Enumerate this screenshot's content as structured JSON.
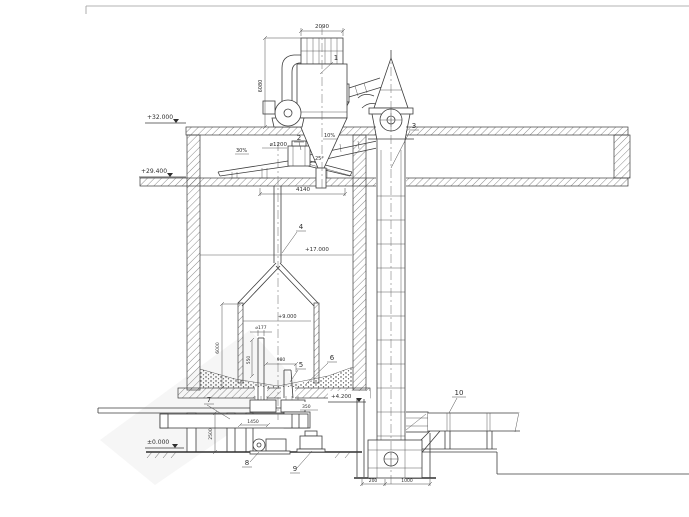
{
  "drawing": {
    "background": "#ffffff",
    "ink": "#3d3d3d",
    "levels": {
      "top": "+32.000",
      "gallery": "+29.400",
      "mid": "+17.000",
      "cone": "+9.000",
      "floor": "+4.200",
      "ground": "±0.000"
    },
    "parts": {
      "p1": "1",
      "p2": "2",
      "p3": "3",
      "p4": "4",
      "p5": "5",
      "p6": "6",
      "p7": "7",
      "p8": "8",
      "p9": "9",
      "p10": "10"
    },
    "dims": {
      "filter_width": "2090",
      "filter_height": "6080",
      "distributor_dia": "⌀1200",
      "spread_width": "4140",
      "slope_left": "30%",
      "chute_slope": "10%",
      "chute_angle": "25°",
      "cone_height": "6000",
      "pipe_dia": "⌀177",
      "pipe_len": "550",
      "pipe_offset": "980",
      "valve_span": "1450",
      "basement_height": "2500",
      "boot_offset": "200",
      "boot_width": "1000",
      "floor_offset": "350"
    }
  }
}
